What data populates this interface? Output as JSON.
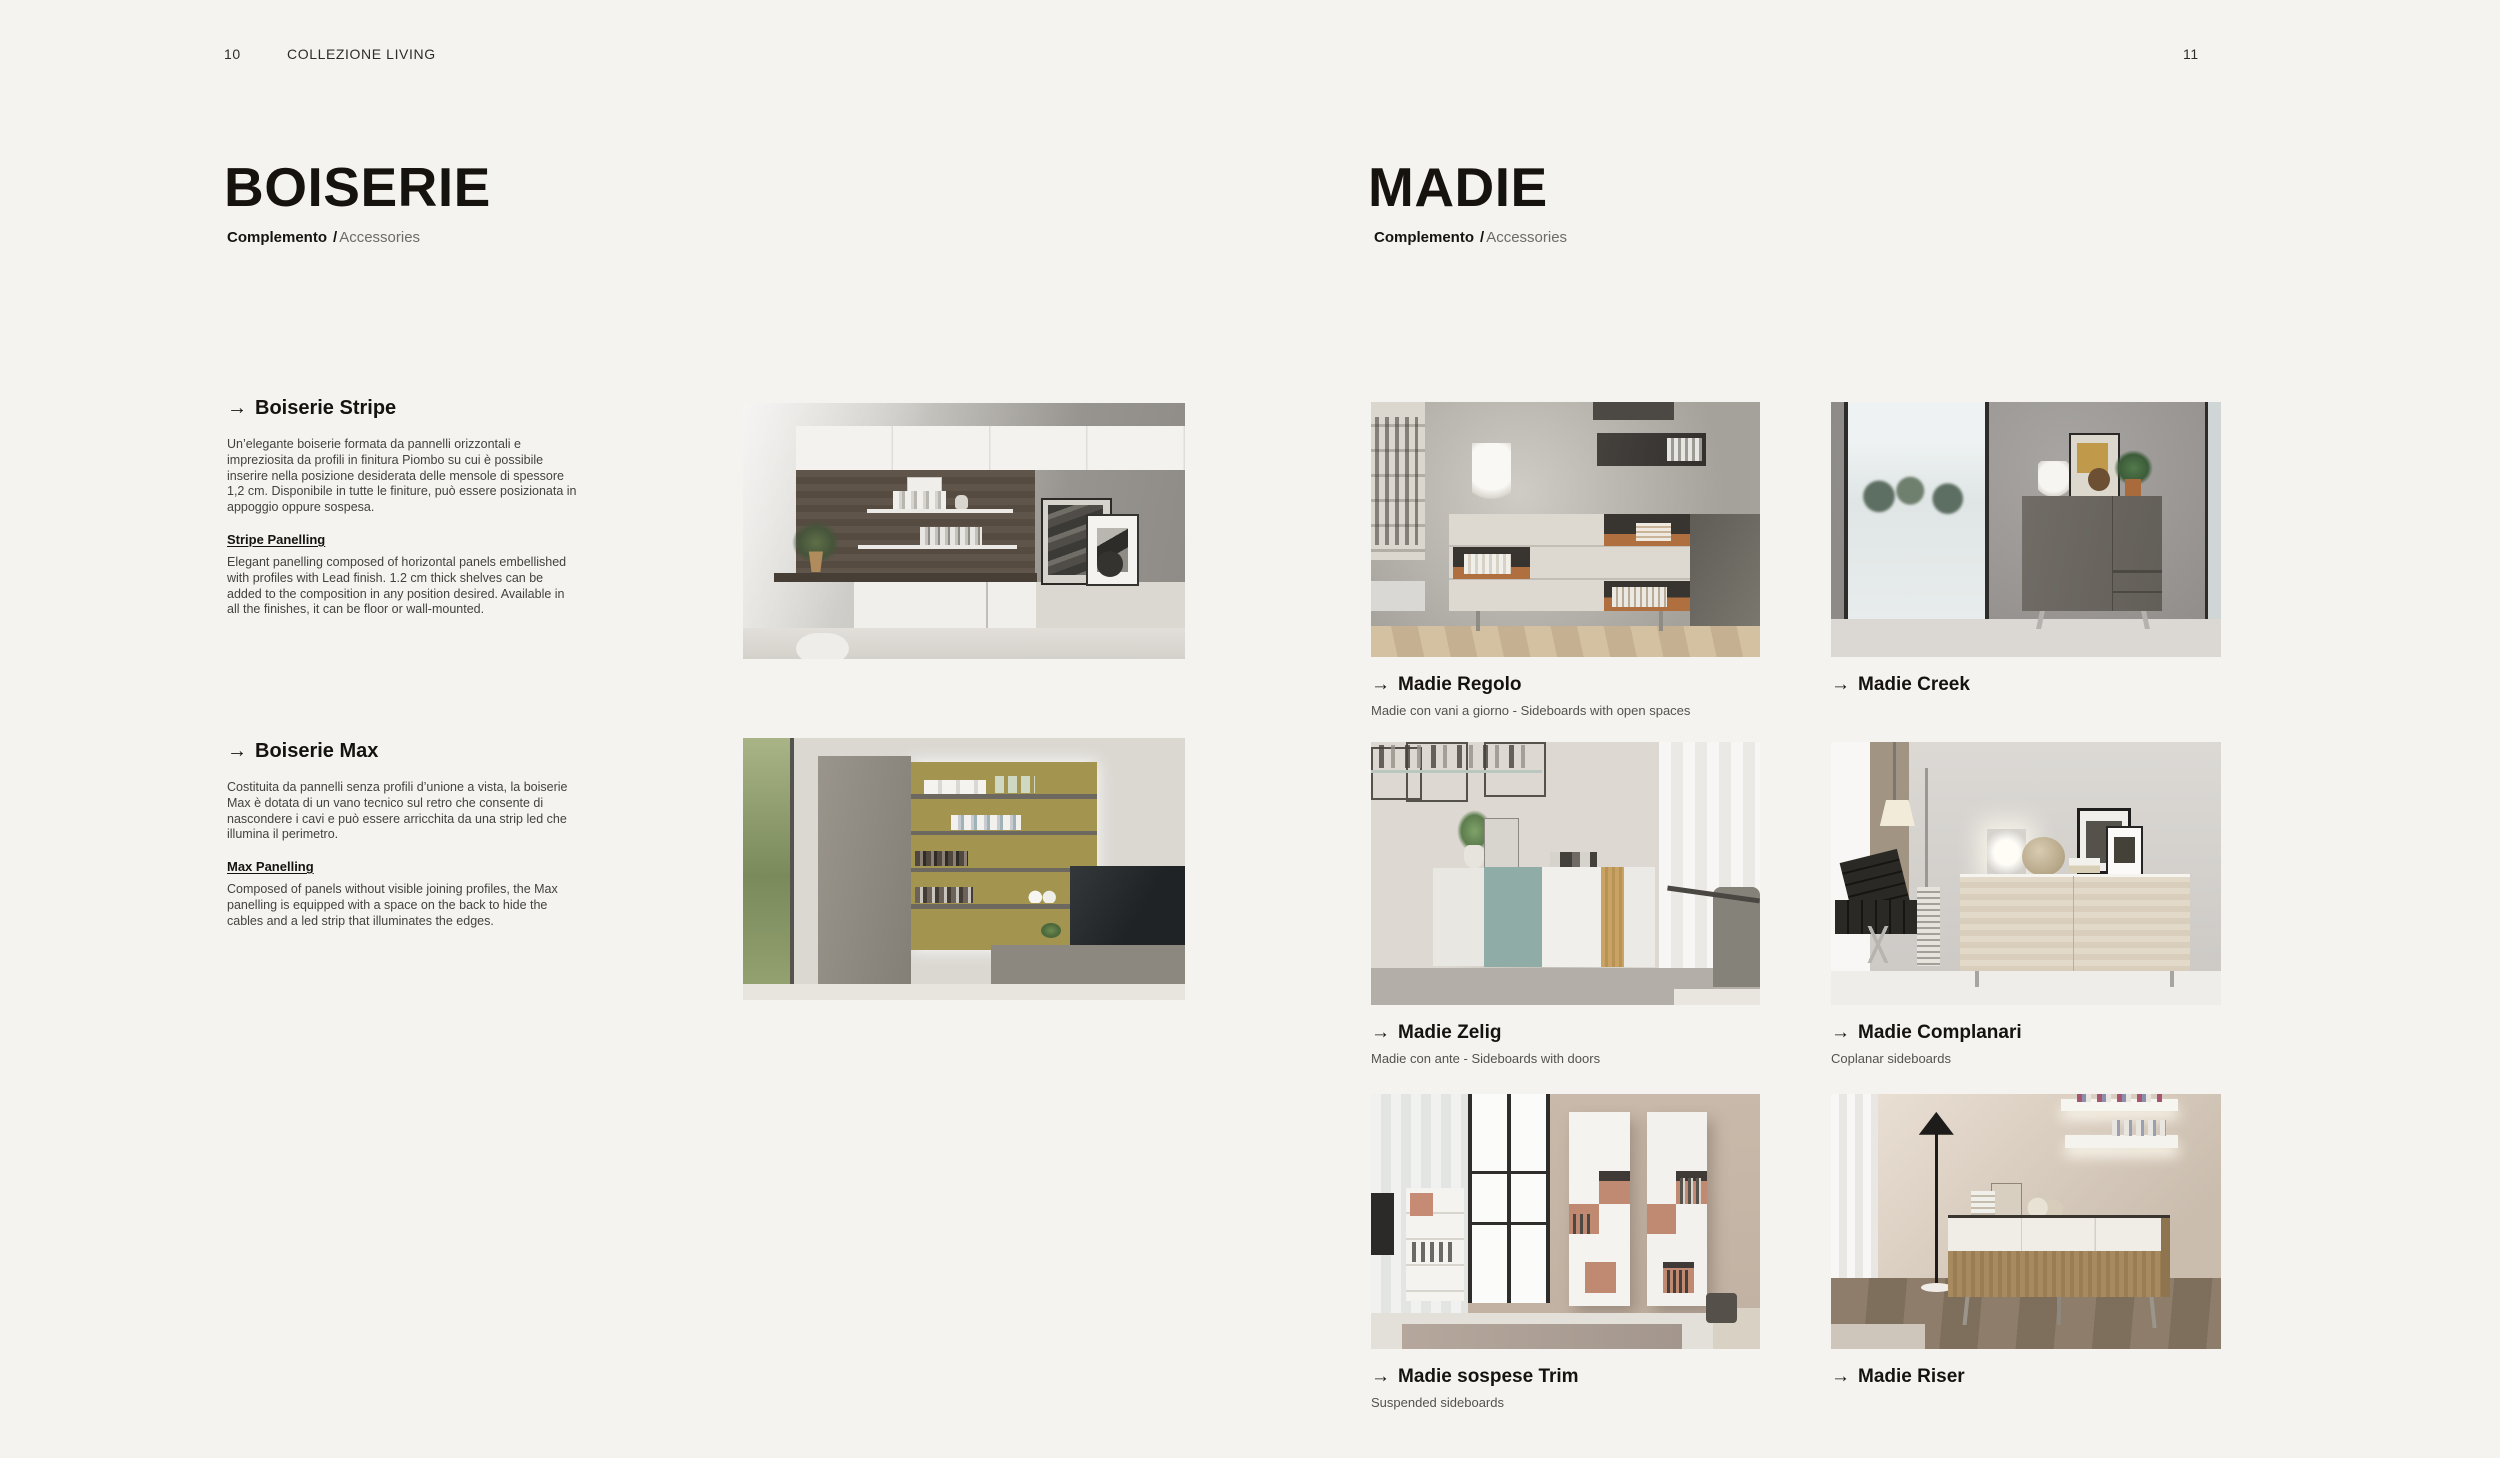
{
  "page": {
    "left_page_number": "10",
    "header_title": "COLLEZIONE LIVING",
    "right_page_number": "11"
  },
  "colors": {
    "page_background": "#f5f3ef",
    "heading_text": "#16130e",
    "body_text": "#44423e",
    "muted_text": "#6e6b66"
  },
  "boiserie": {
    "title": "BOISERIE",
    "subtitle_primary": "Complemento",
    "subtitle_separator": "/",
    "subtitle_secondary": "Accessories",
    "items": [
      {
        "arrow": "→",
        "heading": "Boiserie Stripe",
        "body_it": "Un’elegante boiserie formata da pannelli orizzontali e impreziosita da profili in finitura Piombo su cui è possibile inserire nella posizione desiderata delle mensole di spessore 1,2 cm. Disponibile in tutte le finiture, può essere posizionata in appoggio oppure sospesa.",
        "subheading_en": "Stripe Panelling",
        "body_en": "Elegant panelling composed of horizontal panels embellished with profiles with Lead finish. 1.2 cm thick shelves can be added to the composition in any position desired. Available in all the finishes, it can be floor or wall-mounted."
      },
      {
        "arrow": "→",
        "heading": "Boiserie Max",
        "body_it": "Costituita da pannelli senza profili d’unione a vista, la boiserie Max è dotata di un vano tecnico sul retro che consente di nascondere i cavi e può essere arricchita da una strip led che illumina il perimetro.",
        "subheading_en": "Max Panelling",
        "body_en": "Composed of panels without visible joining profiles, the Max panelling is equipped with a space on the back to hide the cables and a led strip that illuminates the edges."
      }
    ]
  },
  "madie": {
    "title": "MADIE",
    "subtitle_primary": "Complemento",
    "subtitle_separator": "/",
    "subtitle_secondary": "Accessories",
    "products": [
      {
        "arrow": "→",
        "name": "Madie Regolo",
        "description": "Madie con vani a giorno - Sideboards with open spaces"
      },
      {
        "arrow": "→",
        "name": "Madie Creek",
        "description": ""
      },
      {
        "arrow": "→",
        "name": "Madie Zelig",
        "description": "Madie con ante - Sideboards with doors"
      },
      {
        "arrow": "→",
        "name": "Madie Complanari",
        "description": "Coplanar sideboards"
      },
      {
        "arrow": "→",
        "name": "Madie sospese Trim",
        "description": "Suspended sideboards"
      },
      {
        "arrow": "→",
        "name": "Madie Riser",
        "description": ""
      }
    ]
  }
}
